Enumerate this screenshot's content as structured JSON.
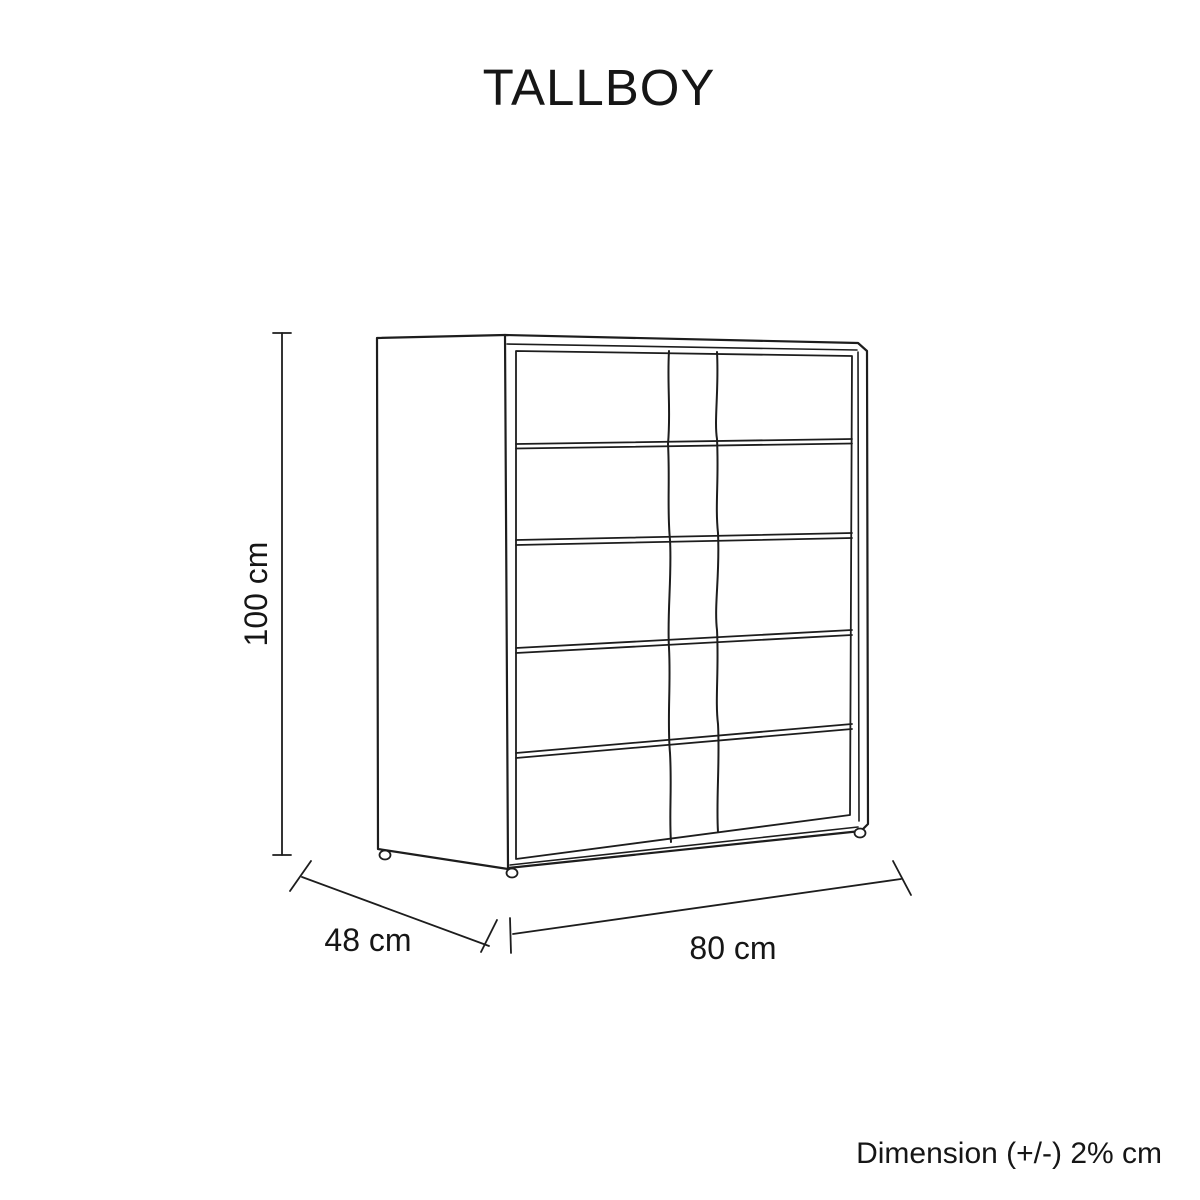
{
  "page": {
    "background_color": "#ffffff",
    "line_color": "#1d1d1d",
    "text_color": "#161616"
  },
  "title": "TALLBOY",
  "figure": {
    "type": "furniture-dimension-diagram",
    "item": "tallboy chest of drawers",
    "drawer_count": 5,
    "dimensions": {
      "height": {
        "value": 100,
        "unit": "cm",
        "label": "100 cm"
      },
      "depth": {
        "value": 48,
        "unit": "cm",
        "label": "48 cm"
      },
      "width": {
        "value": 80,
        "unit": "cm",
        "label": "80 cm"
      }
    },
    "tolerance_note": "Dimension (+/-) 2% cm"
  }
}
